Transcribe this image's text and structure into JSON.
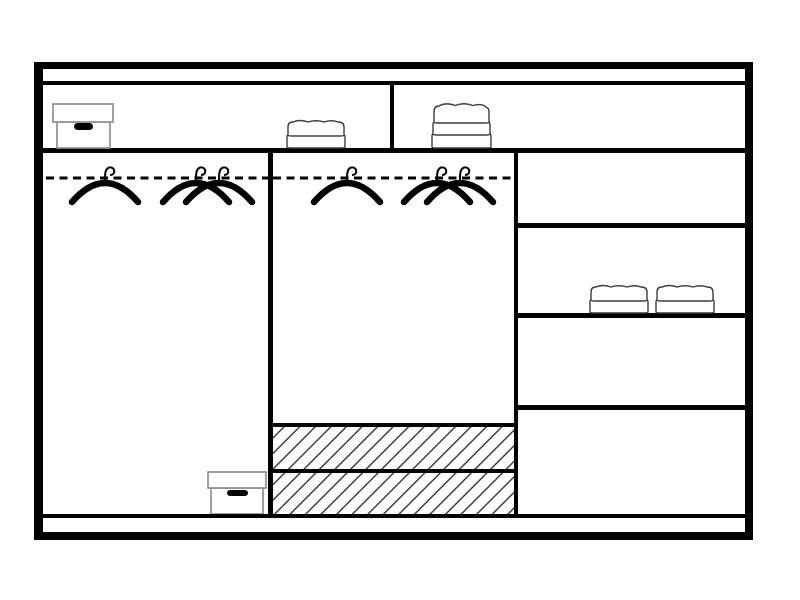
{
  "page": {
    "background": "#ffffff"
  },
  "colors": {
    "background": "#ffffff",
    "line": "#000000",
    "hatch": "#222222",
    "soft-outline": "#8f8f8f",
    "towel-outline": "#3d3d3d"
  },
  "diagram": {
    "kind": "wardrobe interior layout diagram (front view)",
    "top_shelf": {
      "label": "top shelf",
      "left_items": [
        "storage box with handle",
        "stack of 2 folded towels"
      ],
      "right_items": [
        "stack of 3 folded towels"
      ]
    },
    "left_compartment": {
      "label": "left hanging compartment",
      "rail": "clothes rail (dashed line)",
      "hanger_count": 3,
      "floor_items": [
        "storage box with handle"
      ]
    },
    "middle_compartment": {
      "label": "middle hanging compartment",
      "rail": "clothes rail (dashed line)",
      "hanger_count": 3,
      "drawer_count": 2,
      "drawer_style": "diagonal hatch"
    },
    "right_column": {
      "label": "right shelf column",
      "shelf_count": 4,
      "items": [
        "stack of 2 folded towels",
        "stack of 2 folded towels"
      ]
    },
    "totals": {
      "hanger_count": 6,
      "drawer_count": 2,
      "box_count": 2,
      "towel_stack_count": 4
    }
  }
}
